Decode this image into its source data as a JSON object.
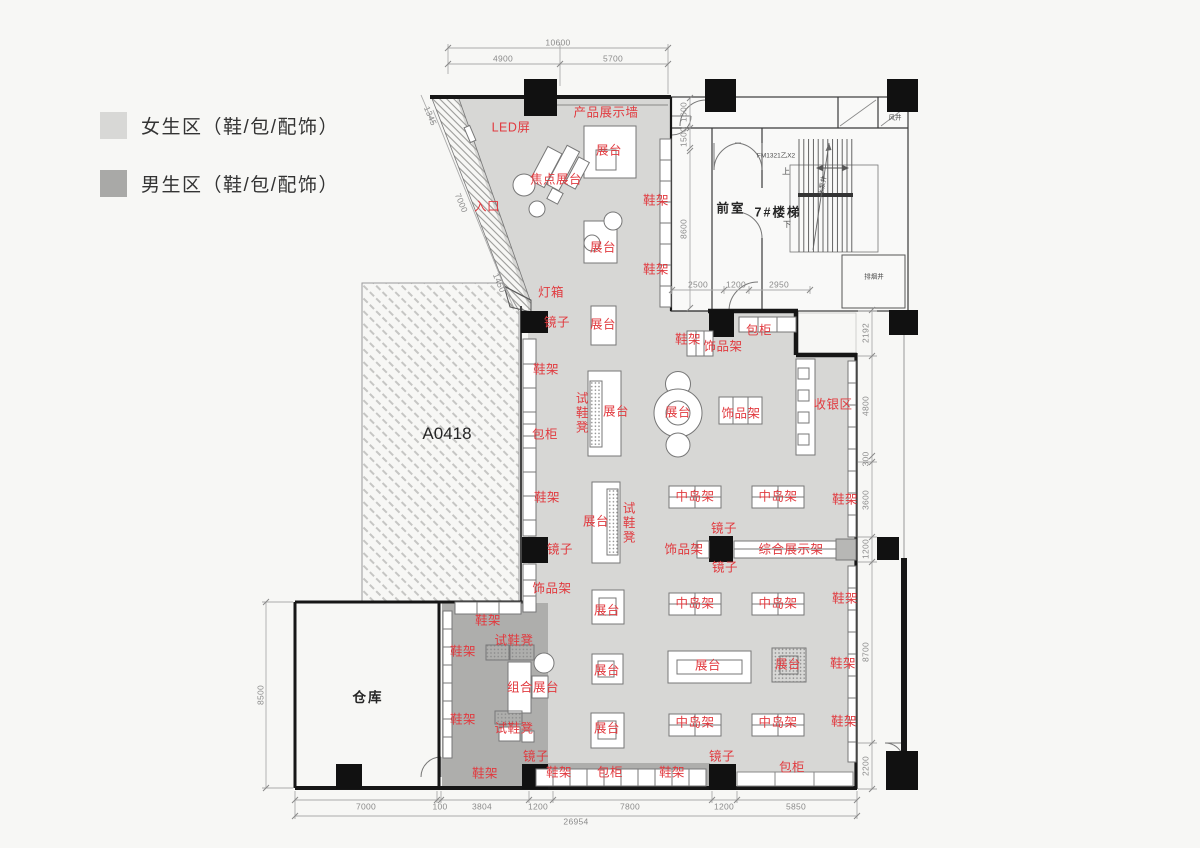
{
  "legend": {
    "items": [
      {
        "label": "女生区（鞋/包/配饰）",
        "color": "#d8d8d6"
      },
      {
        "label": "男生区（鞋/包/配饰）",
        "color": "#a9a9a7"
      }
    ]
  },
  "plan": {
    "colors": {
      "women_zone": "#d7d7d5",
      "men_zone": "#aeaeac",
      "accent": "#e13a3f"
    },
    "room_labels": [
      {
        "t": "仓库",
        "x": 368,
        "y": 698,
        "size": 13.5
      },
      {
        "t": "A0418",
        "x": 447,
        "y": 434,
        "size": 17,
        "plain": 1
      },
      {
        "t": "前室",
        "x": 731,
        "y": 209,
        "size": 12.5
      },
      {
        "t": "7#楼梯",
        "x": 778,
        "y": 213,
        "size": 12.5
      }
    ],
    "fixture_labels": [
      {
        "t": "LED屏",
        "x": 511,
        "y": 128
      },
      {
        "t": "产品展示墙",
        "x": 606,
        "y": 113
      },
      {
        "t": "展台",
        "x": 609,
        "y": 151
      },
      {
        "t": "焦点展台",
        "x": 556,
        "y": 180
      },
      {
        "t": "入口",
        "x": 487,
        "y": 207
      },
      {
        "t": "鞋架",
        "x": 656,
        "y": 201
      },
      {
        "t": "展台",
        "x": 603,
        "y": 248
      },
      {
        "t": "鞋架",
        "x": 656,
        "y": 270
      },
      {
        "t": "灯箱",
        "x": 551,
        "y": 293
      },
      {
        "t": "镜子",
        "x": 557,
        "y": 323
      },
      {
        "t": "展台",
        "x": 603,
        "y": 325
      },
      {
        "t": "鞋架",
        "x": 688,
        "y": 340
      },
      {
        "t": "饰品架",
        "x": 723,
        "y": 347
      },
      {
        "t": "包柜",
        "x": 759,
        "y": 331
      },
      {
        "t": "鞋架",
        "x": 546,
        "y": 370
      },
      {
        "t": "试鞋凳",
        "x": 580,
        "y": 413,
        "v": 1
      },
      {
        "t": "展台",
        "x": 616,
        "y": 412
      },
      {
        "t": "展台",
        "x": 678,
        "y": 413
      },
      {
        "t": "饰品架",
        "x": 741,
        "y": 414
      },
      {
        "t": "收银区",
        "x": 833,
        "y": 405
      },
      {
        "t": "包柜",
        "x": 545,
        "y": 435
      },
      {
        "t": "鞋架",
        "x": 547,
        "y": 498
      },
      {
        "t": "中岛架",
        "x": 695,
        "y": 497
      },
      {
        "t": "中岛架",
        "x": 778,
        "y": 497
      },
      {
        "t": "鞋架",
        "x": 845,
        "y": 500
      },
      {
        "t": "展台",
        "x": 596,
        "y": 522
      },
      {
        "t": "试鞋凳",
        "x": 627,
        "y": 523,
        "v": 1
      },
      {
        "t": "镜子",
        "x": 724,
        "y": 529
      },
      {
        "t": "饰品架",
        "x": 684,
        "y": 550
      },
      {
        "t": "综合展示架",
        "x": 791,
        "y": 550
      },
      {
        "t": "镜子",
        "x": 725,
        "y": 568
      },
      {
        "t": "镜子",
        "x": 560,
        "y": 550
      },
      {
        "t": "饰品架",
        "x": 552,
        "y": 589
      },
      {
        "t": "中岛架",
        "x": 695,
        "y": 604
      },
      {
        "t": "中岛架",
        "x": 778,
        "y": 604
      },
      {
        "t": "鞋架",
        "x": 845,
        "y": 599
      },
      {
        "t": "展台",
        "x": 607,
        "y": 611
      },
      {
        "t": "鞋架",
        "x": 488,
        "y": 621
      },
      {
        "t": "试鞋凳",
        "x": 514,
        "y": 641
      },
      {
        "t": "鞋架",
        "x": 463,
        "y": 652
      },
      {
        "t": "展台",
        "x": 607,
        "y": 671
      },
      {
        "t": "组合展台",
        "x": 533,
        "y": 688
      },
      {
        "t": "展台",
        "x": 708,
        "y": 666
      },
      {
        "t": "展台",
        "x": 788,
        "y": 665
      },
      {
        "t": "鞋架",
        "x": 843,
        "y": 664
      },
      {
        "t": "试鞋凳",
        "x": 514,
        "y": 729
      },
      {
        "t": "鞋架",
        "x": 463,
        "y": 720
      },
      {
        "t": "展台",
        "x": 607,
        "y": 729
      },
      {
        "t": "中岛架",
        "x": 695,
        "y": 723
      },
      {
        "t": "中岛架",
        "x": 778,
        "y": 723
      },
      {
        "t": "鞋架",
        "x": 844,
        "y": 722
      },
      {
        "t": "镜子",
        "x": 536,
        "y": 757
      },
      {
        "t": "鞋架",
        "x": 485,
        "y": 774
      },
      {
        "t": "鞋架",
        "x": 559,
        "y": 773
      },
      {
        "t": "包柜",
        "x": 610,
        "y": 773
      },
      {
        "t": "鞋架",
        "x": 672,
        "y": 773
      },
      {
        "t": "镜子",
        "x": 722,
        "y": 757
      },
      {
        "t": "包柜",
        "x": 792,
        "y": 768
      }
    ],
    "dimension_labels": [
      {
        "t": "10600",
        "x": 558,
        "y": 43
      },
      {
        "t": "4900",
        "x": 503,
        "y": 59
      },
      {
        "t": "5700",
        "x": 613,
        "y": 59
      },
      {
        "t": "1345",
        "x": 430,
        "y": 116,
        "rot": 67
      },
      {
        "t": "7000",
        "x": 461,
        "y": 203,
        "rot": 67
      },
      {
        "t": "1450",
        "x": 499,
        "y": 283,
        "rot": 67
      },
      {
        "t": "1600",
        "x": 684,
        "y": 112,
        "rot": -90
      },
      {
        "t": "1500",
        "x": 684,
        "y": 137,
        "rot": -90
      },
      {
        "t": "8600",
        "x": 684,
        "y": 229,
        "rot": -90
      },
      {
        "t": "2500",
        "x": 698,
        "y": 285
      },
      {
        "t": "1200",
        "x": 736,
        "y": 285
      },
      {
        "t": "2950",
        "x": 779,
        "y": 285
      },
      {
        "t": "2192",
        "x": 866,
        "y": 333,
        "rot": -90
      },
      {
        "t": "4800",
        "x": 866,
        "y": 406,
        "rot": -90
      },
      {
        "t": "300",
        "x": 866,
        "y": 459,
        "rot": -90
      },
      {
        "t": "3600",
        "x": 866,
        "y": 500,
        "rot": -90
      },
      {
        "t": "1200",
        "x": 866,
        "y": 549,
        "rot": -90
      },
      {
        "t": "8700",
        "x": 866,
        "y": 652,
        "rot": -90
      },
      {
        "t": "2200",
        "x": 866,
        "y": 766,
        "rot": -90
      },
      {
        "t": "8500",
        "x": 261,
        "y": 695,
        "rot": -90
      },
      {
        "t": "7000",
        "x": 366,
        "y": 807
      },
      {
        "t": "100",
        "x": 440,
        "y": 807
      },
      {
        "t": "3804",
        "x": 482,
        "y": 807
      },
      {
        "t": "1200",
        "x": 538,
        "y": 807
      },
      {
        "t": "7800",
        "x": 630,
        "y": 807
      },
      {
        "t": "1200",
        "x": 724,
        "y": 807
      },
      {
        "t": "5850",
        "x": 796,
        "y": 807
      },
      {
        "t": "26954",
        "x": 576,
        "y": 822
      }
    ],
    "annotation_labels": [
      {
        "t": "FM1321乙X2",
        "x": 776,
        "y": 157
      },
      {
        "t": "上",
        "x": 786,
        "y": 172,
        "size": 8
      },
      {
        "t": "下",
        "x": 787,
        "y": 225,
        "size": 8
      },
      {
        "t": "风井",
        "x": 895,
        "y": 119
      },
      {
        "t": "排烟井",
        "x": 874,
        "y": 278
      },
      {
        "t": "水泵井",
        "x": 824,
        "y": 186,
        "rot": -80
      }
    ]
  }
}
